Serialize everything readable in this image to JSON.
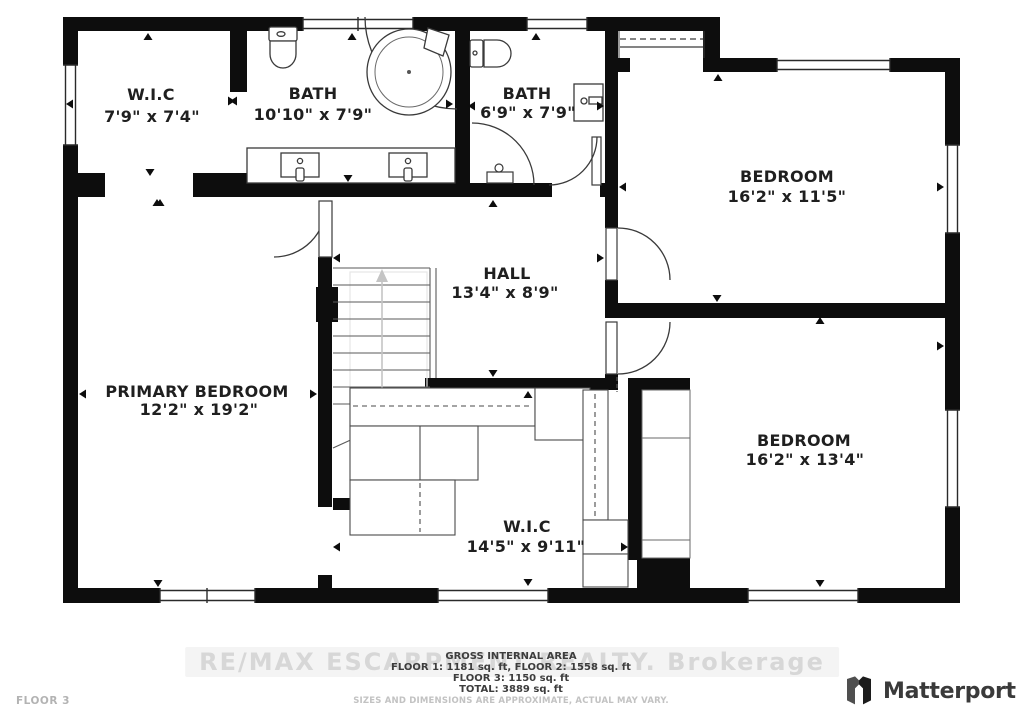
{
  "rooms": {
    "wic_top": {
      "name": "W.I.C",
      "dims": "7'9\" x 7'4\""
    },
    "bath_main": {
      "name": "BATH",
      "dims": "10'10\" x 7'9\""
    },
    "bath_small": {
      "name": "BATH",
      "dims": "6'9\" x 7'9\""
    },
    "bedroom_top": {
      "name": "BEDROOM",
      "dims": "16'2\" x 11'5\""
    },
    "hall": {
      "name": "HALL",
      "dims": "13'4\" x 8'9\""
    },
    "primary_bedroom": {
      "name": "PRIMARY BEDROOM",
      "dims": "12'2\" x 19'2\""
    },
    "bedroom_bottom": {
      "name": "BEDROOM",
      "dims": "16'2\" x 13'4\""
    },
    "wic_bottom": {
      "name": "W.I.C",
      "dims": "14'5\" x 9'11\""
    }
  },
  "footer": {
    "area_title": "GROSS INTERNAL AREA",
    "line1": "FLOOR 1: 1181 sq. ft, FLOOR 2: 1558 sq. ft",
    "line2": "FLOOR 3: 1150 sq. ft",
    "line3": "TOTAL: 3889 sq. ft",
    "disclaimer": "SIZES AND DIMENSIONS ARE APPROXIMATE, ACTUAL MAY VARY."
  },
  "floor_label": "FLOOR 3",
  "watermark": "RE/MAX ESCARPMENT REALTY. Brokerage",
  "brand": {
    "name": "Matterport"
  },
  "colors": {
    "wall": "#0d0d0d",
    "label": "#1f1f1f",
    "fixture_line": "#3a3a3a",
    "muted": "#c2c2c2",
    "watermark": "#d7d7d7",
    "brand_text": "#3a3a3a"
  }
}
